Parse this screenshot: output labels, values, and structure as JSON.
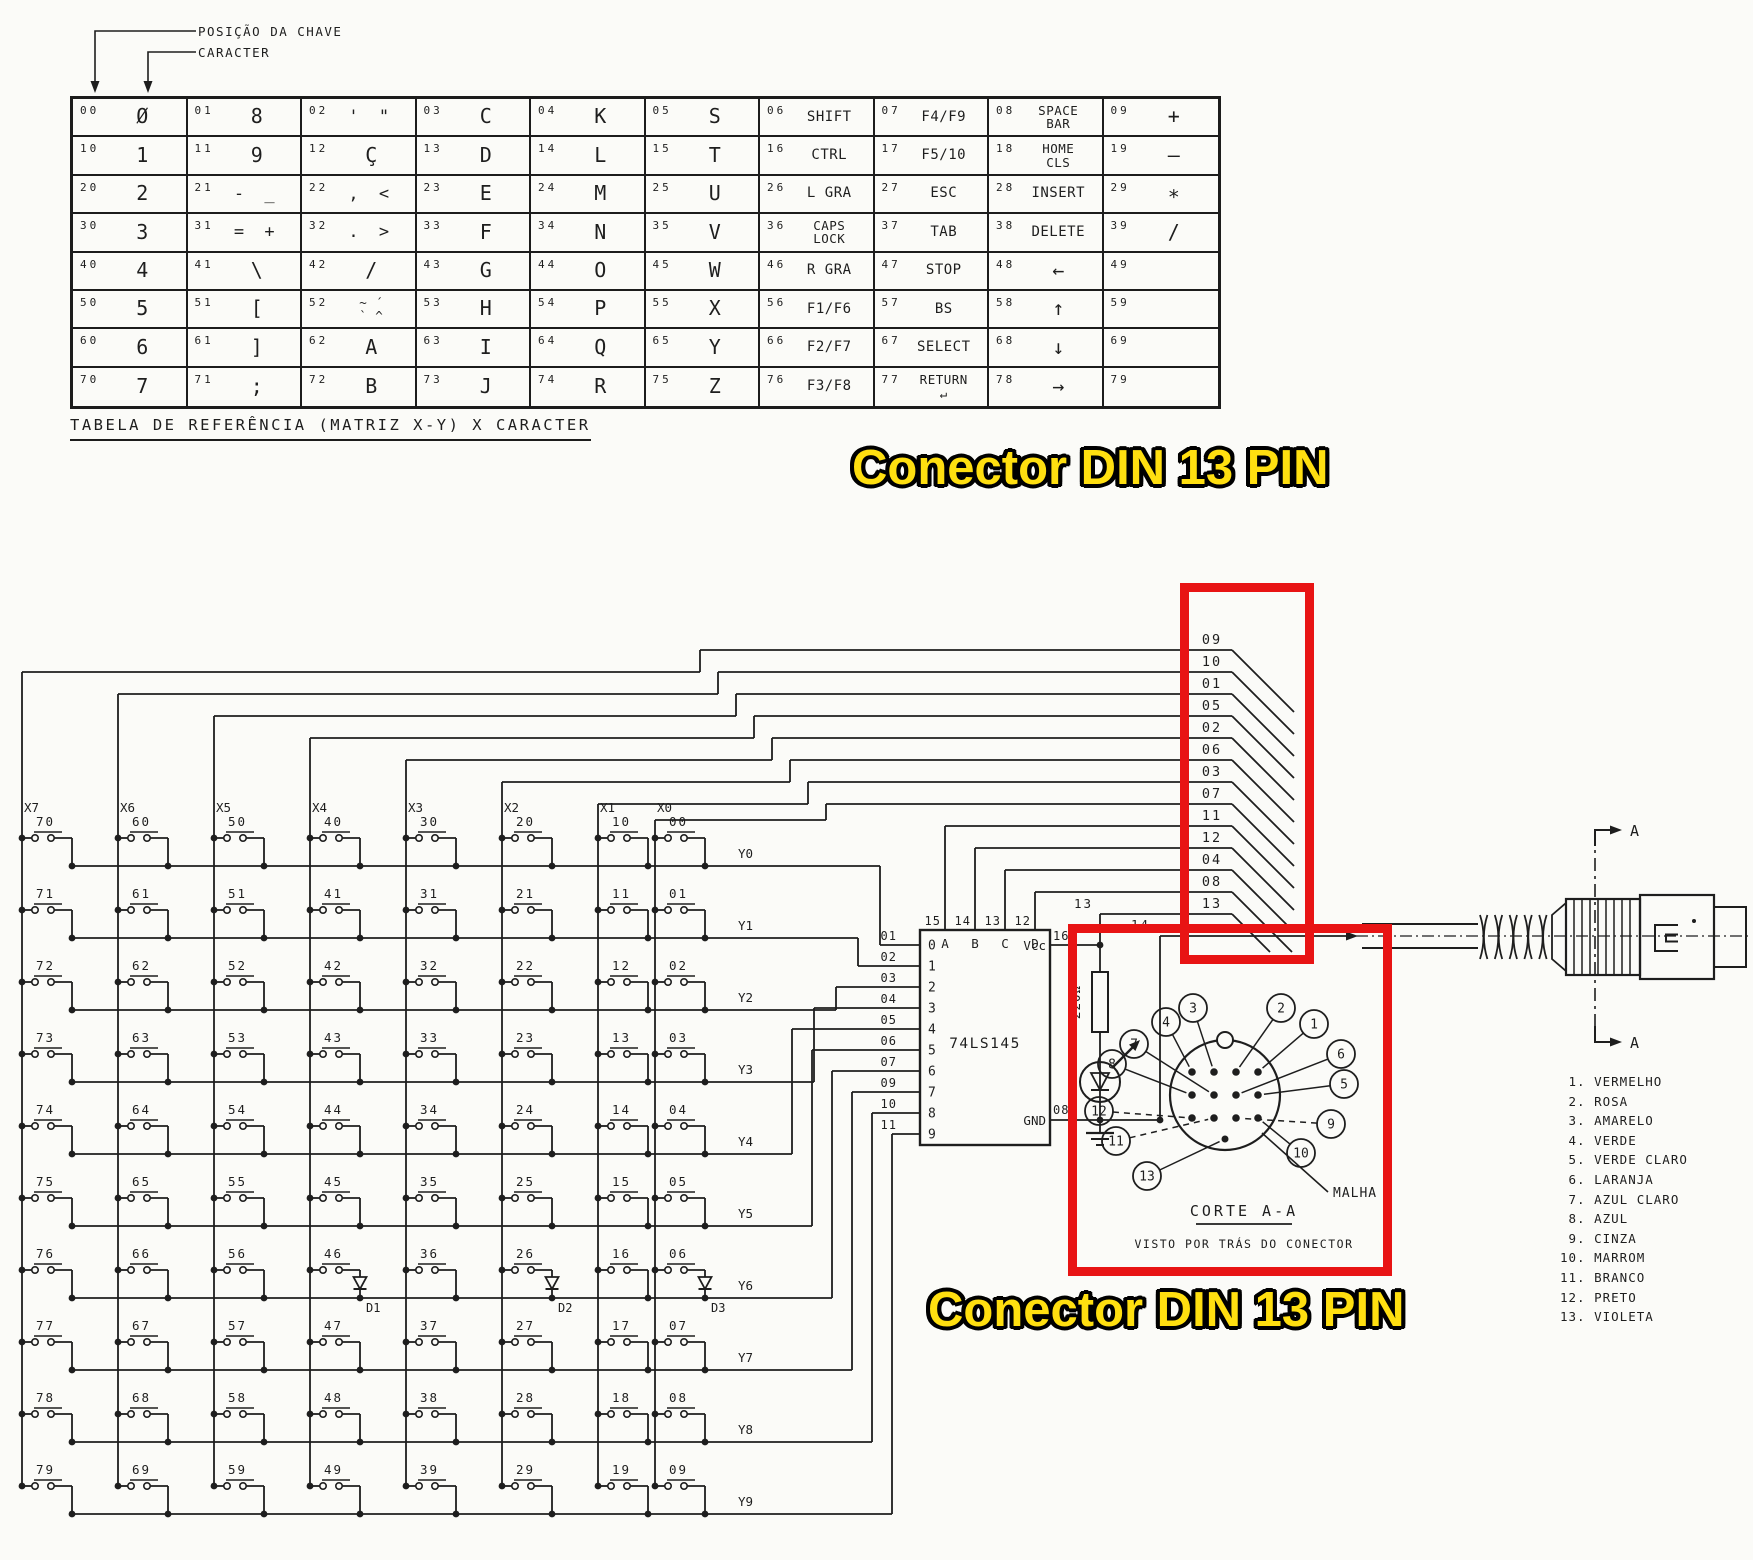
{
  "table": {
    "caption": "TABELA DE REFERÊNCIA (MATRIZ X-Y) X CARACTER",
    "annotation_key_position": "POSIÇÃO DA CHAVE",
    "annotation_character": "CARACTER",
    "rows": [
      [
        {
          "pos": "00",
          "ch": "Ø"
        },
        {
          "pos": "01",
          "ch": "8"
        },
        {
          "pos": "02",
          "ch": "' \""
        },
        {
          "pos": "03",
          "ch": "C"
        },
        {
          "pos": "04",
          "ch": "K"
        },
        {
          "pos": "05",
          "ch": "S"
        },
        {
          "pos": "06",
          "ch": "SHIFT"
        },
        {
          "pos": "07",
          "ch": "F4/F9"
        },
        {
          "pos": "08",
          "ch": "SPACE\nBAR"
        },
        {
          "pos": "09",
          "ch": "+"
        }
      ],
      [
        {
          "pos": "10",
          "ch": "1"
        },
        {
          "pos": "11",
          "ch": "9"
        },
        {
          "pos": "12",
          "ch": "Ç"
        },
        {
          "pos": "13",
          "ch": "D"
        },
        {
          "pos": "14",
          "ch": "L"
        },
        {
          "pos": "15",
          "ch": "T"
        },
        {
          "pos": "16",
          "ch": "CTRL"
        },
        {
          "pos": "17",
          "ch": "F5/10"
        },
        {
          "pos": "18",
          "ch": "HOME\nCLS"
        },
        {
          "pos": "19",
          "ch": "—"
        }
      ],
      [
        {
          "pos": "20",
          "ch": "2"
        },
        {
          "pos": "21",
          "ch": "- _"
        },
        {
          "pos": "22",
          "ch": ", <"
        },
        {
          "pos": "23",
          "ch": "E"
        },
        {
          "pos": "24",
          "ch": "M"
        },
        {
          "pos": "25",
          "ch": "U"
        },
        {
          "pos": "26",
          "ch": "L GRA"
        },
        {
          "pos": "27",
          "ch": "ESC"
        },
        {
          "pos": "28",
          "ch": "INSERT"
        },
        {
          "pos": "29",
          "ch": "∗"
        }
      ],
      [
        {
          "pos": "30",
          "ch": "3"
        },
        {
          "pos": "31",
          "ch": "= +"
        },
        {
          "pos": "32",
          "ch": ". >"
        },
        {
          "pos": "33",
          "ch": "F"
        },
        {
          "pos": "34",
          "ch": "N"
        },
        {
          "pos": "35",
          "ch": "V"
        },
        {
          "pos": "36",
          "ch": "CAPS\nLOCK"
        },
        {
          "pos": "37",
          "ch": "TAB"
        },
        {
          "pos": "38",
          "ch": "DELETE"
        },
        {
          "pos": "39",
          "ch": "/"
        }
      ],
      [
        {
          "pos": "40",
          "ch": "4"
        },
        {
          "pos": "41",
          "ch": "\\"
        },
        {
          "pos": "42",
          "ch": "/"
        },
        {
          "pos": "43",
          "ch": "G"
        },
        {
          "pos": "44",
          "ch": "O"
        },
        {
          "pos": "45",
          "ch": "W"
        },
        {
          "pos": "46",
          "ch": "R GRA"
        },
        {
          "pos": "47",
          "ch": "STOP"
        },
        {
          "pos": "48",
          "ch": "←"
        },
        {
          "pos": "49",
          "ch": ""
        }
      ],
      [
        {
          "pos": "50",
          "ch": "5"
        },
        {
          "pos": "51",
          "ch": "["
        },
        {
          "pos": "52",
          "ch": "~ ´\n` ^"
        },
        {
          "pos": "53",
          "ch": "H"
        },
        {
          "pos": "54",
          "ch": "P"
        },
        {
          "pos": "55",
          "ch": "X"
        },
        {
          "pos": "56",
          "ch": "F1/F6"
        },
        {
          "pos": "57",
          "ch": "BS"
        },
        {
          "pos": "58",
          "ch": "↑"
        },
        {
          "pos": "59",
          "ch": ""
        }
      ],
      [
        {
          "pos": "60",
          "ch": "6"
        },
        {
          "pos": "61",
          "ch": "]"
        },
        {
          "pos": "62",
          "ch": "A"
        },
        {
          "pos": "63",
          "ch": "I"
        },
        {
          "pos": "64",
          "ch": "Q"
        },
        {
          "pos": "65",
          "ch": "Y"
        },
        {
          "pos": "66",
          "ch": "F2/F7"
        },
        {
          "pos": "67",
          "ch": "SELECT"
        },
        {
          "pos": "68",
          "ch": "↓"
        },
        {
          "pos": "69",
          "ch": ""
        }
      ],
      [
        {
          "pos": "70",
          "ch": "7"
        },
        {
          "pos": "71",
          "ch": ";"
        },
        {
          "pos": "72",
          "ch": "B"
        },
        {
          "pos": "73",
          "ch": "J"
        },
        {
          "pos": "74",
          "ch": "R"
        },
        {
          "pos": "75",
          "ch": "Z"
        },
        {
          "pos": "76",
          "ch": "F3/F8"
        },
        {
          "pos": "77",
          "ch": "RETURN\n↵"
        },
        {
          "pos": "78",
          "ch": "→"
        },
        {
          "pos": "79",
          "ch": ""
        }
      ]
    ]
  },
  "banners": {
    "top": "Conector DIN 13 PIN",
    "bottom": "Conector DIN 13 PIN",
    "text_color": "#ffdf10",
    "box_color": "#e81414"
  },
  "schematic": {
    "columns": [
      {
        "label": "X7",
        "switches": [
          "70",
          "71",
          "72",
          "73",
          "74",
          "75",
          "76",
          "77",
          "78",
          "79"
        ]
      },
      {
        "label": "X6",
        "switches": [
          "60",
          "61",
          "62",
          "63",
          "64",
          "65",
          "66",
          "67",
          "68",
          "69"
        ]
      },
      {
        "label": "X5",
        "switches": [
          "50",
          "51",
          "52",
          "53",
          "54",
          "55",
          "56",
          "57",
          "58",
          "59"
        ]
      },
      {
        "label": "X4",
        "switches": [
          "40",
          "41",
          "42",
          "43",
          "44",
          "45",
          "46",
          "47",
          "48",
          "49"
        ]
      },
      {
        "label": "X3",
        "switches": [
          "30",
          "31",
          "32",
          "33",
          "34",
          "35",
          "36",
          "37",
          "38",
          "39"
        ]
      },
      {
        "label": "X2",
        "switches": [
          "20",
          "21",
          "22",
          "23",
          "24",
          "25",
          "26",
          "27",
          "28",
          "29"
        ]
      },
      {
        "label": "X1",
        "switches": [
          "10",
          "11",
          "12",
          "13",
          "14",
          "15",
          "16",
          "17",
          "18",
          "19"
        ]
      },
      {
        "label": "X0",
        "switches": [
          "00",
          "01",
          "02",
          "03",
          "04",
          "05",
          "06",
          "07",
          "08",
          "09"
        ]
      }
    ],
    "row_labels": [
      "Y0",
      "Y1",
      "Y2",
      "Y3",
      "Y4",
      "Y5",
      "Y6",
      "Y7",
      "Y8",
      "Y9"
    ],
    "diodes": [
      "D1",
      "D2",
      "D3"
    ],
    "ic": {
      "name": "74LS145",
      "left_pins": [
        [
          "01",
          "0"
        ],
        [
          "02",
          "1"
        ],
        [
          "03",
          "2"
        ],
        [
          "04",
          "3"
        ],
        [
          "05",
          "4"
        ],
        [
          "06",
          "5"
        ],
        [
          "07",
          "6"
        ],
        [
          "09",
          "7"
        ],
        [
          "10",
          "8"
        ],
        [
          "11",
          "9"
        ]
      ],
      "top_pins": [
        [
          "15",
          "A"
        ],
        [
          "14",
          "B"
        ],
        [
          "13",
          "C"
        ],
        [
          "12",
          "D"
        ]
      ],
      "vcc_pin": "16",
      "vcc": "Vcc",
      "gnd_pin": "08",
      "gnd": "GND"
    },
    "resistor": "220Ω",
    "wires": [
      "09",
      "10",
      "01",
      "05",
      "02",
      "06",
      "03",
      "07",
      "11",
      "12",
      "04",
      "08",
      "13"
    ],
    "wire13_label": "13",
    "wire14_label": "14",
    "section_label": "A",
    "din_face": {
      "callouts": [
        "3",
        "4",
        "2",
        "1",
        "7",
        "8",
        "6",
        "5",
        "12",
        "11",
        "9",
        "10",
        "13"
      ],
      "shield": "MALHA",
      "corte": "CORTE A-A",
      "visto": "VISTO POR TRÁS DO CONECTOR"
    },
    "legend": [
      {
        "n": "1",
        "name": "VERMELHO"
      },
      {
        "n": "2",
        "name": "ROSA"
      },
      {
        "n": "3",
        "name": "AMARELO"
      },
      {
        "n": "4",
        "name": "VERDE"
      },
      {
        "n": "5",
        "name": "VERDE CLARO"
      },
      {
        "n": "6",
        "name": "LARANJA"
      },
      {
        "n": "7",
        "name": "AZUL CLARO"
      },
      {
        "n": "8",
        "name": "AZUL"
      },
      {
        "n": "9",
        "name": "CINZA"
      },
      {
        "n": "10",
        "name": "MARROM"
      },
      {
        "n": "11",
        "name": "BRANCO"
      },
      {
        "n": "12",
        "name": "PRETO"
      },
      {
        "n": "13",
        "name": "VIOLETA"
      }
    ]
  }
}
